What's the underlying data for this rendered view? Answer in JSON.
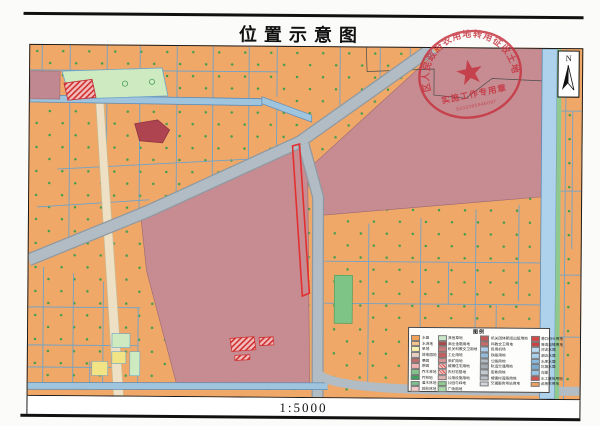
{
  "page": {
    "title": "位置示意图",
    "scale_label": "1:5000"
  },
  "north_arrow": {
    "label": "N"
  },
  "stamp": {
    "arc_text": "区人民政府农用地转用征收土地",
    "line_text": "实施工作专用章",
    "number": "5203295946097",
    "color": "#C5313D"
  },
  "map_colors": {
    "farmland_orange": "#F0A868",
    "built_up_mauve": "#C68C92",
    "road_gray": "#B2BCC4",
    "water_blue": "#AED2EC",
    "parcel_line_blue": "#6FA3C9",
    "highlight_outline_red": "#E23030"
  },
  "legend": {
    "title": "图例",
    "columns": [
      {
        "items": [
          {
            "label": "水田",
            "color": "#F4A259"
          },
          {
            "label": "水浇地",
            "color": "#F8C58C"
          },
          {
            "label": "旱地",
            "color": "#F9F2AE"
          },
          {
            "label": "其他园地",
            "color": "#E7CFC3"
          },
          {
            "label": "果园",
            "color": "#C26B6B"
          },
          {
            "label": "茶园",
            "color": "#EFB3B3"
          },
          {
            "label": "乔木林地",
            "color": "#82C48A"
          },
          {
            "label": "竹林地",
            "color": "#3F9E5D"
          },
          {
            "label": "灌木林地",
            "color": "#7FBE8D"
          },
          {
            "label": "其他林地",
            "color": "#EFC8C8"
          }
        ]
      },
      {
        "items": [
          {
            "label": "其他草地",
            "color": "#C9E7C9"
          },
          {
            "label": "商业金融用地",
            "color": "#A94A4A"
          },
          {
            "label": "机关科教文卫用地",
            "color": "#C97A7A"
          },
          {
            "label": "工业用地",
            "color": "#C26060"
          },
          {
            "label": "采矿用地",
            "color": "#DB9494"
          },
          {
            "label": "城镇住宅用地",
            "color": "#D94545",
            "hatch": true
          },
          {
            "label": "农村宅基地",
            "color": "#EAA6A6",
            "hatch": true
          },
          {
            "label": "公用设施用地",
            "color": "#E2B5B5"
          },
          {
            "label": "公园与绿地",
            "color": "#92CB92"
          },
          {
            "label": "广场用地",
            "color": "#ABD9AB"
          }
        ]
      },
      {
        "items": [
          {
            "label": "机关团体新闻出版用地",
            "color": "#C25858"
          },
          {
            "label": "科教文卫用地",
            "color": "#CC6A6A"
          },
          {
            "label": "民用机场",
            "color": "#ABCBE8"
          },
          {
            "label": "铁路用地",
            "color": "#93BADA"
          },
          {
            "label": "公路用地",
            "color": "#B3BBC3"
          },
          {
            "label": "轨道交通用地",
            "color": "#A2AAB2"
          },
          {
            "label": "街巷用地",
            "color": "#C2CAD2"
          },
          {
            "label": "城镇村道路用地",
            "color": "#BAC2CA"
          },
          {
            "label": "交通服务场站用地",
            "color": "#D2D6DA"
          }
        ]
      },
      {
        "items": [
          {
            "label": "港口码头用地",
            "color": "#D14949"
          },
          {
            "label": "管道运输用地",
            "color": "#C94141"
          },
          {
            "label": "河流水面",
            "color": "#BBDAF1"
          },
          {
            "label": "湖泊水面",
            "color": "#ABD2ED"
          },
          {
            "label": "水库水面",
            "color": "#8ABAE1"
          },
          {
            "label": "坑塘水面",
            "color": "#7AAACD"
          },
          {
            "label": "沟渠",
            "color": "#9AC6E5"
          },
          {
            "label": "水工建筑用地",
            "color": "#D15252"
          },
          {
            "label": "设施农用地",
            "color": "#EAA261"
          }
        ]
      }
    ]
  }
}
